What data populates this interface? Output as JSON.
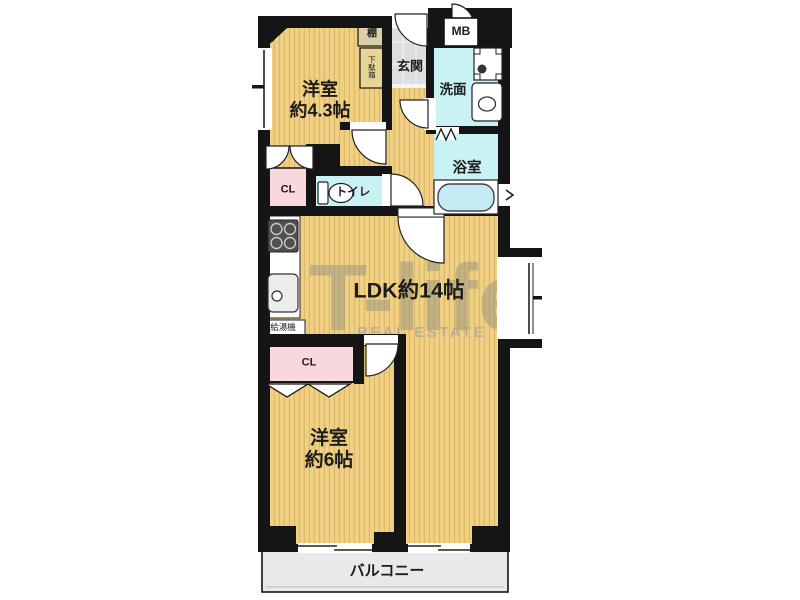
{
  "floor_plan": {
    "watermark": {
      "brand": "T-life",
      "subtitle": "REAL ESTATE"
    },
    "rooms": {
      "bedroom_small": {
        "name_line1": "洋室",
        "name_line2": "約4.3帖"
      },
      "bedroom_large": {
        "name_line1": "洋室",
        "name_line2": "約6帖"
      },
      "ldk": {
        "name": "LDK約14帖"
      },
      "entrance": {
        "name": "玄関"
      },
      "washroom": {
        "name": "洗面"
      },
      "bathroom": {
        "name": "浴室"
      },
      "toilet": {
        "name": "トイレ"
      },
      "closet_upper": {
        "name": "CL"
      },
      "closet_lower": {
        "name": "CL"
      },
      "balcony": {
        "name": "バルコニー"
      },
      "meter_box": {
        "name": "MB"
      },
      "shelf": {
        "name": "棚"
      },
      "shoe_cabinet": {
        "name": "下駄箱"
      },
      "water_heater": {
        "name": "給湯機"
      }
    },
    "colors": {
      "tatami_base": "#F0D085",
      "tatami_stripe": "#DDB966",
      "wet_area": "#C9F2F5",
      "closet": "#F8D8DC",
      "entrance_tile": "#DEDEDE",
      "balcony": "#E9E9E9",
      "wall": "#151515",
      "bathtub": "#C2EBF4",
      "watermark_gray": "#969482"
    }
  }
}
